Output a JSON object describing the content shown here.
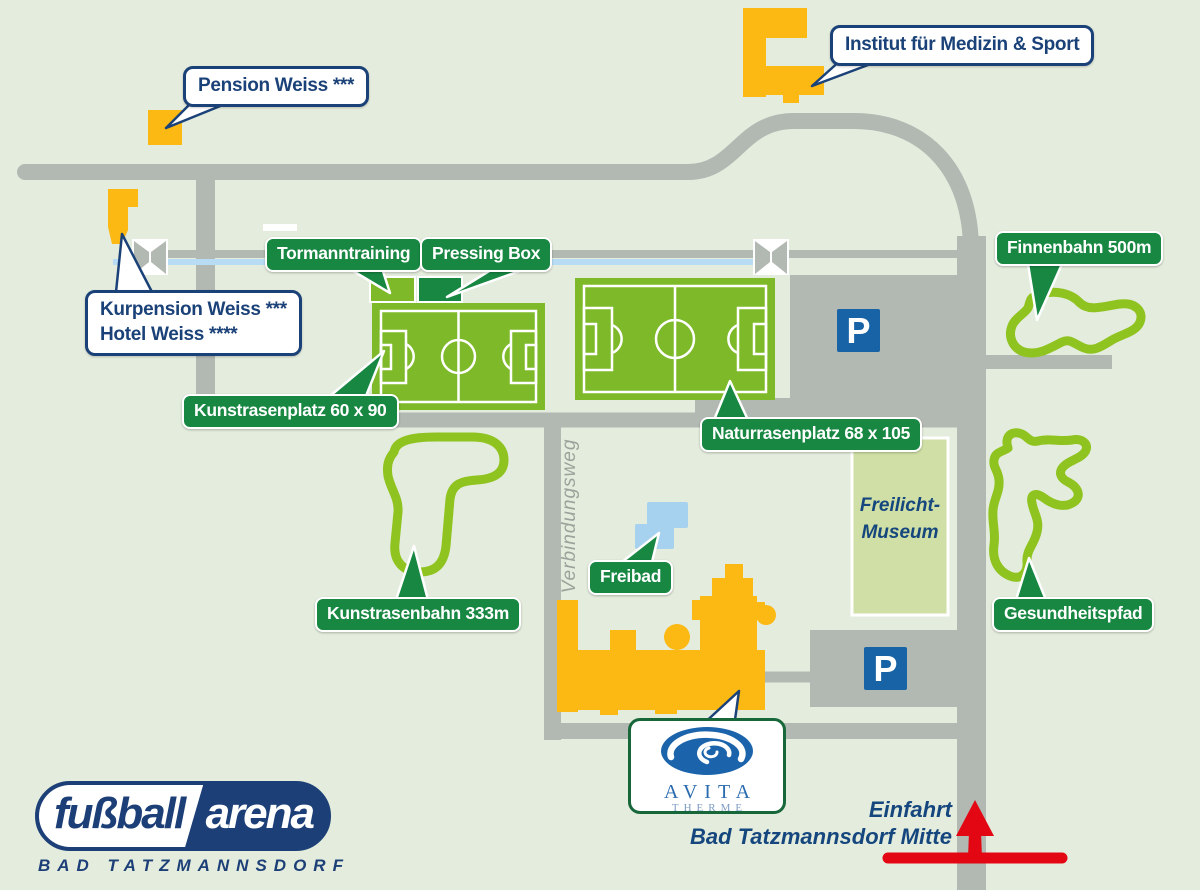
{
  "colors": {
    "background": "#e4ecdd",
    "road_gray": "#b2b8b2",
    "pitch_green": "#7db929",
    "label_green": "#178742",
    "trail_green": "#8fc31f",
    "building_orange": "#fcb813",
    "navy": "#1b4278",
    "parking_blue": "#1763a6",
    "pool_blue": "#a6d1ef",
    "stream_blue": "#b8dcf4",
    "museum_fill": "#cfdfa5",
    "arrow_red": "#e30613",
    "avita_blue": "#1b64ab"
  },
  "green_labels": [
    {
      "text": "Tormanntraining"
    },
    {
      "text": "Pressing Box"
    },
    {
      "text": "Kunstrasenplatz 60 x 90"
    },
    {
      "text": "Naturrasenplatz 68 x 105"
    },
    {
      "text": "Finnenbahn 500m"
    },
    {
      "text": "Freibad"
    },
    {
      "text": "Kunstrasenbahn 333m"
    },
    {
      "text": "Gesundheitspfad"
    }
  ],
  "bubbles": {
    "pension": "Pension Weiss ***",
    "institut": "Institut für Medizin & Sport",
    "kurpension_line1": "Kurpension Weiss ***",
    "kurpension_line2": "Hotel Weiss ****"
  },
  "areas": {
    "museum_line1": "Freilicht-",
    "museum_line2": "Museum",
    "verbindungsweg": "Verbindungsweg"
  },
  "entry": {
    "line1": "Einfahrt",
    "line2": "Bad Tatzmannsdorf Mitte"
  },
  "avita": {
    "name": "AVITA",
    "subtitle": "THERME"
  },
  "parking": {
    "symbol": "P"
  },
  "logo": {
    "word1": "fußball",
    "word2": "arena",
    "subtitle": "BAD TATZMANNSDORF"
  }
}
